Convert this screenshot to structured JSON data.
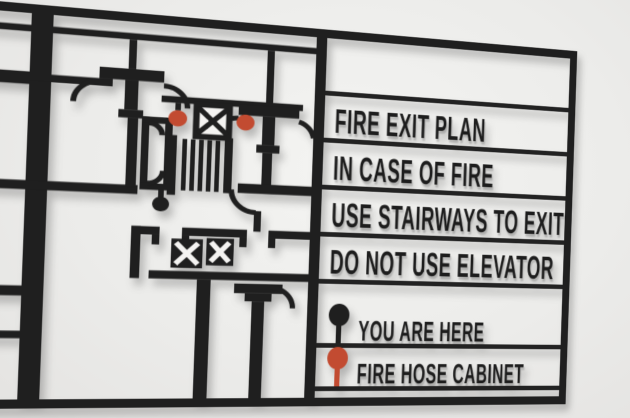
{
  "colors": {
    "wall": "#ececea",
    "sign": "#1f1f1f",
    "marker_red": "#c24b31",
    "interior_white": "#f4f3f1"
  },
  "panel": {
    "messages": [
      "FIRE EXIT PLAN",
      "IN CASE OF FIRE",
      "USE STAIRWAYS TO EXIT",
      "DO NOT USE ELEVATOR"
    ],
    "legend": [
      {
        "label": "YOU ARE HERE",
        "marker": "black-pin",
        "color": "#1f1f1f"
      },
      {
        "label": "FIRE HOSE CABINET",
        "marker": "red-pin",
        "color": "#c24b31"
      }
    ]
  },
  "plan": {
    "markers": [
      {
        "name": "fire-hose-cabinet-pin",
        "color": "#c24b31",
        "count": 2
      },
      {
        "name": "you-are-here-dot",
        "color": "#1f1f1f",
        "count": 1
      }
    ],
    "symbols": [
      "stairway-treads",
      "elevator-x",
      "elevator-x",
      "utility-x"
    ]
  }
}
